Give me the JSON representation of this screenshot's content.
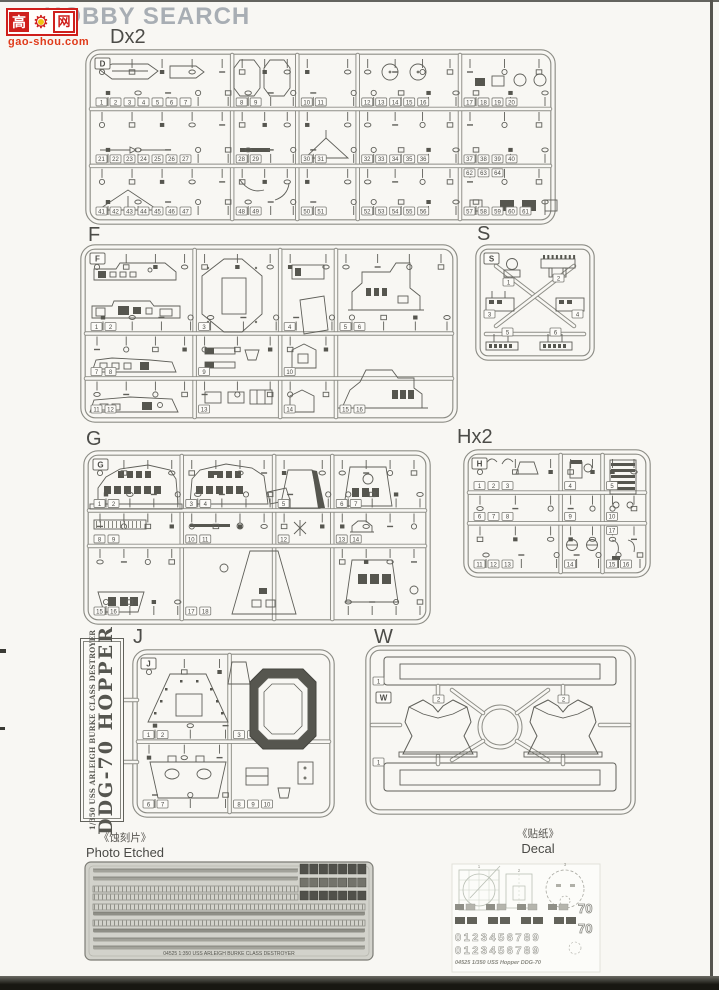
{
  "watermark": {
    "brand": "HOBBY SEARCH",
    "site_cn_left": "高",
    "site_cn_right": "网",
    "site_url": "gao-shou.com"
  },
  "sections": {
    "d": {
      "label": "Dx2",
      "tag": "D",
      "parts": [
        1,
        2,
        3,
        4,
        5,
        6,
        7,
        8,
        9,
        10,
        11,
        12,
        13,
        14,
        15,
        16,
        17,
        18,
        19,
        20,
        21,
        22,
        23,
        24,
        25,
        26,
        27,
        28,
        29,
        30,
        31,
        32,
        33,
        34,
        35,
        36,
        37,
        38,
        39,
        40,
        41,
        42,
        43,
        44,
        45,
        46,
        47,
        48,
        49,
        50,
        51,
        52,
        53,
        54,
        55,
        56,
        57,
        58,
        59,
        60,
        61,
        62,
        63,
        64
      ]
    },
    "f": {
      "label": "F",
      "tag": "F",
      "parts": [
        1,
        2,
        3,
        4,
        5,
        6,
        7,
        8,
        9,
        10,
        11,
        12,
        13,
        14,
        15,
        16
      ]
    },
    "s": {
      "label": "S",
      "tag": "S",
      "parts": [
        1,
        2,
        3,
        4,
        5,
        6
      ]
    },
    "g": {
      "label": "G",
      "tag": "G",
      "parts": [
        1,
        2,
        3,
        4,
        5,
        6,
        7,
        8,
        9,
        10,
        11,
        12,
        13,
        14,
        15,
        16,
        17,
        18
      ]
    },
    "h": {
      "label": "Hx2",
      "tag": "H",
      "parts": [
        1,
        2,
        3,
        4,
        5,
        6,
        7,
        8,
        9,
        10,
        11,
        12,
        13,
        14,
        15,
        16,
        17
      ]
    },
    "j": {
      "label": "J",
      "tag": "J",
      "parts": [
        1,
        2,
        3,
        4,
        5,
        6,
        7,
        8,
        9,
        10
      ]
    },
    "w": {
      "label": "W",
      "tag": "W",
      "parts": [
        1,
        2,
        2,
        1
      ]
    }
  },
  "nameplate": {
    "line1": "1/350 USS ARLEIGH BURKE CLASS DESTROYER",
    "line2": "DDG-70 HOPPER"
  },
  "photo_etched": {
    "label_cn": "《蚀刻片》",
    "label_en": "Photo Etched",
    "fret_text": "04525 1:350 USS ARLEIGH BURKE CLASS DESTROYER"
  },
  "decal": {
    "label_cn": "《贴纸》",
    "label_en": "Decal",
    "sheet_text": "04525 1/350 USS Hopper DDG-70",
    "numerals": "0123456789",
    "hull_number": "70",
    "item_numbers": [
      "1",
      "2",
      "3"
    ]
  },
  "colors": {
    "logo_red": "#cf1f1c",
    "logo_yellow": "#f1c40f",
    "url_orange": "#e03b1b",
    "watermark_gray": "#a8aeb4",
    "line_art": "#5f5f59",
    "runner": "#8d8d86",
    "dark_part": "#56564f",
    "pe_fret": "#d2d2cb",
    "paper": "#f8f7f3"
  }
}
